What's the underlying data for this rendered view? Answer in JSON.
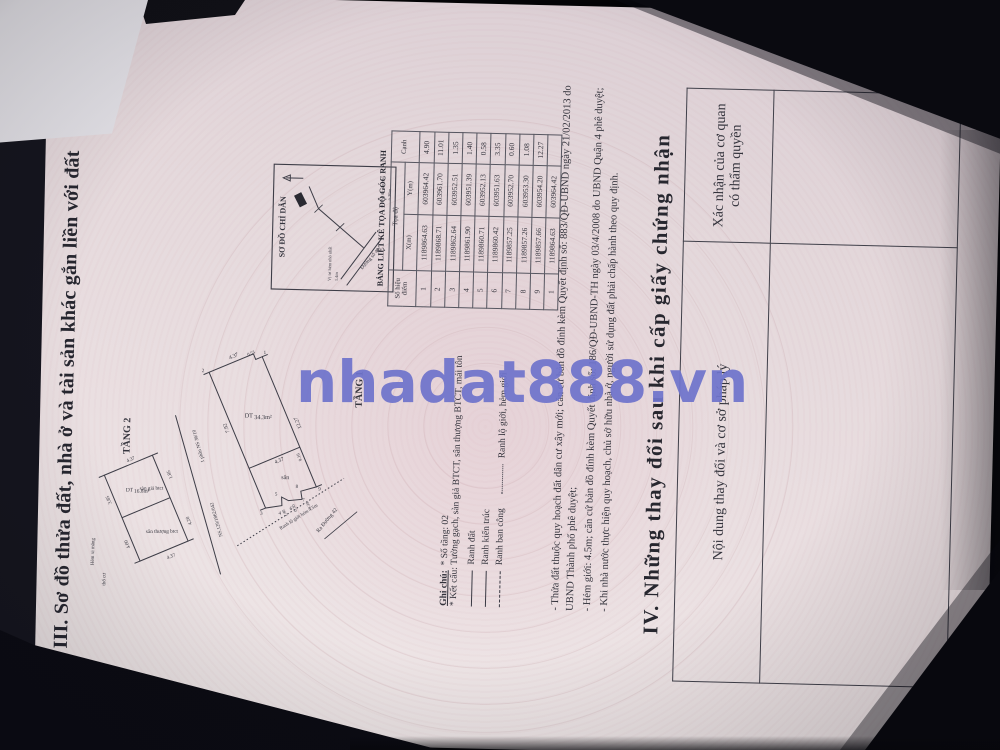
{
  "watermark": {
    "text": "nhadat888.vn",
    "color": "#6f74cc"
  },
  "section3": {
    "title": "III. Sơ đồ thửa đất, nhà ở và tài sản khác gắn liền với đất"
  },
  "plans": {
    "tang1": {
      "label": "TẦNG 1",
      "area_prefix": "DT",
      "area": "34.3m²",
      "yard": "sân",
      "d_front": "4.37",
      "d_jog": "0.53",
      "d_long": "12.27",
      "d_house": "7.92",
      "d_mid": "9.16",
      "d_div": "4.37",
      "d_r1": "1.40",
      "d_r2": "0.30",
      "d_r3": "3.35",
      "points": [
        "1",
        "2",
        "3",
        "4",
        "5",
        "6",
        "7",
        "8",
        "9"
      ],
      "neighbor1": "1 phần NS 36/10",
      "neighbor2": "NS.129/1862/042",
      "boundary_label": "Ranh lộ giới hẻm 4.5m",
      "street_label": "Ra Đường 42"
    },
    "tang2": {
      "label": "TẦNG 2",
      "area_prefix": "DT",
      "area": "16.8m²",
      "floor": "sàn giả btct",
      "terrace": "sân thượng btct",
      "d_t1": "3.85",
      "d_t2": "4.00",
      "d_b1": "1.85",
      "d_b2": "4.20",
      "d_e1": "4.37",
      "d_e2": "4.37",
      "alley": "Hẻm xi măng",
      "land": "thổ cư"
    }
  },
  "guide_map": {
    "title": "SƠ ĐỒ CHỈ DẪN",
    "street": "Đường số 42",
    "label_alley_1": "Vị trí hẻm nhỏ nhất",
    "label_alley_2": "1.4m",
    "label_house_1": "Vị trí căn nhà",
    "label_house_2": "≈ 36m"
  },
  "coord_table": {
    "title": "BẢNG LIỆT KÊ TỌA ĐỘ GÓC RANH",
    "col_point": "Số hiệu điểm",
    "col_coord": "Tọa độ",
    "col_x": "X(m)",
    "col_y": "Y(m)",
    "col_edge": "Cạnh",
    "rows": [
      [
        "1",
        "1189864.63",
        "603964.42",
        "4.90"
      ],
      [
        "2",
        "1189868.71",
        "603961.70",
        "11.01"
      ],
      [
        "3",
        "1189862.64",
        "603952.51",
        "1.35"
      ],
      [
        "4",
        "1189861.90",
        "603951.39",
        "1.40"
      ],
      [
        "5",
        "1189860.71",
        "603952.13",
        "0.58"
      ],
      [
        "6",
        "1189860.42",
        "603951.63",
        "3.35"
      ],
      [
        "7",
        "1189857.25",
        "603952.70",
        "0.60"
      ],
      [
        "8",
        "1189857.26",
        "603953.30",
        "1.08"
      ],
      [
        "9",
        "1189857.66",
        "603954.20",
        "12.27"
      ],
      [
        "1",
        "1189864.63",
        "603964.42",
        ""
      ]
    ]
  },
  "notes": {
    "heading": "Ghi chú:",
    "floors": "* Số tầng: 02",
    "structure": "* Kết cấu: Tường gạch, sàn giả BTCT, sân thượng BTCT, mái tôn",
    "legend": [
      {
        "style": "solid",
        "label": "Ranh đất"
      },
      {
        "style": "solid",
        "label": "Ranh kiến trúc"
      },
      {
        "style": "dashed",
        "label": "Ranh ban công"
      },
      {
        "style": "dotted",
        "label": "Ranh lộ giới, hẻm giới"
      }
    ],
    "paragraphs": [
      "- Thửa đất thuộc quy hoạch đất dân cư xây mới; căn cứ bản đồ đính kèm Quyết định số: 883/QĐ-UBND ngày 21/02/2013 do UBND Thành phố phê duyệt;",
      "- Hẻm giới: 4.5m; căn cứ bản đồ đính kèm Quyết định số: 186/QĐ-UBND-TH ngày 03/4/2008 do UBND Quận 4 phê duyệt;",
      "- Khi nhà nước thực hiện quy hoạch, chủ sở hữu nhà ở, người sử dụng đất phải chấp hành theo quy định."
    ]
  },
  "section4": {
    "title": "IV. Những thay đổi sau khi cấp giấy chứng nhận",
    "col_content": "Nội dung thay đổi và cơ sở pháp lý",
    "col_confirm": "Xác nhận của cơ quan có thẩm quyền"
  }
}
